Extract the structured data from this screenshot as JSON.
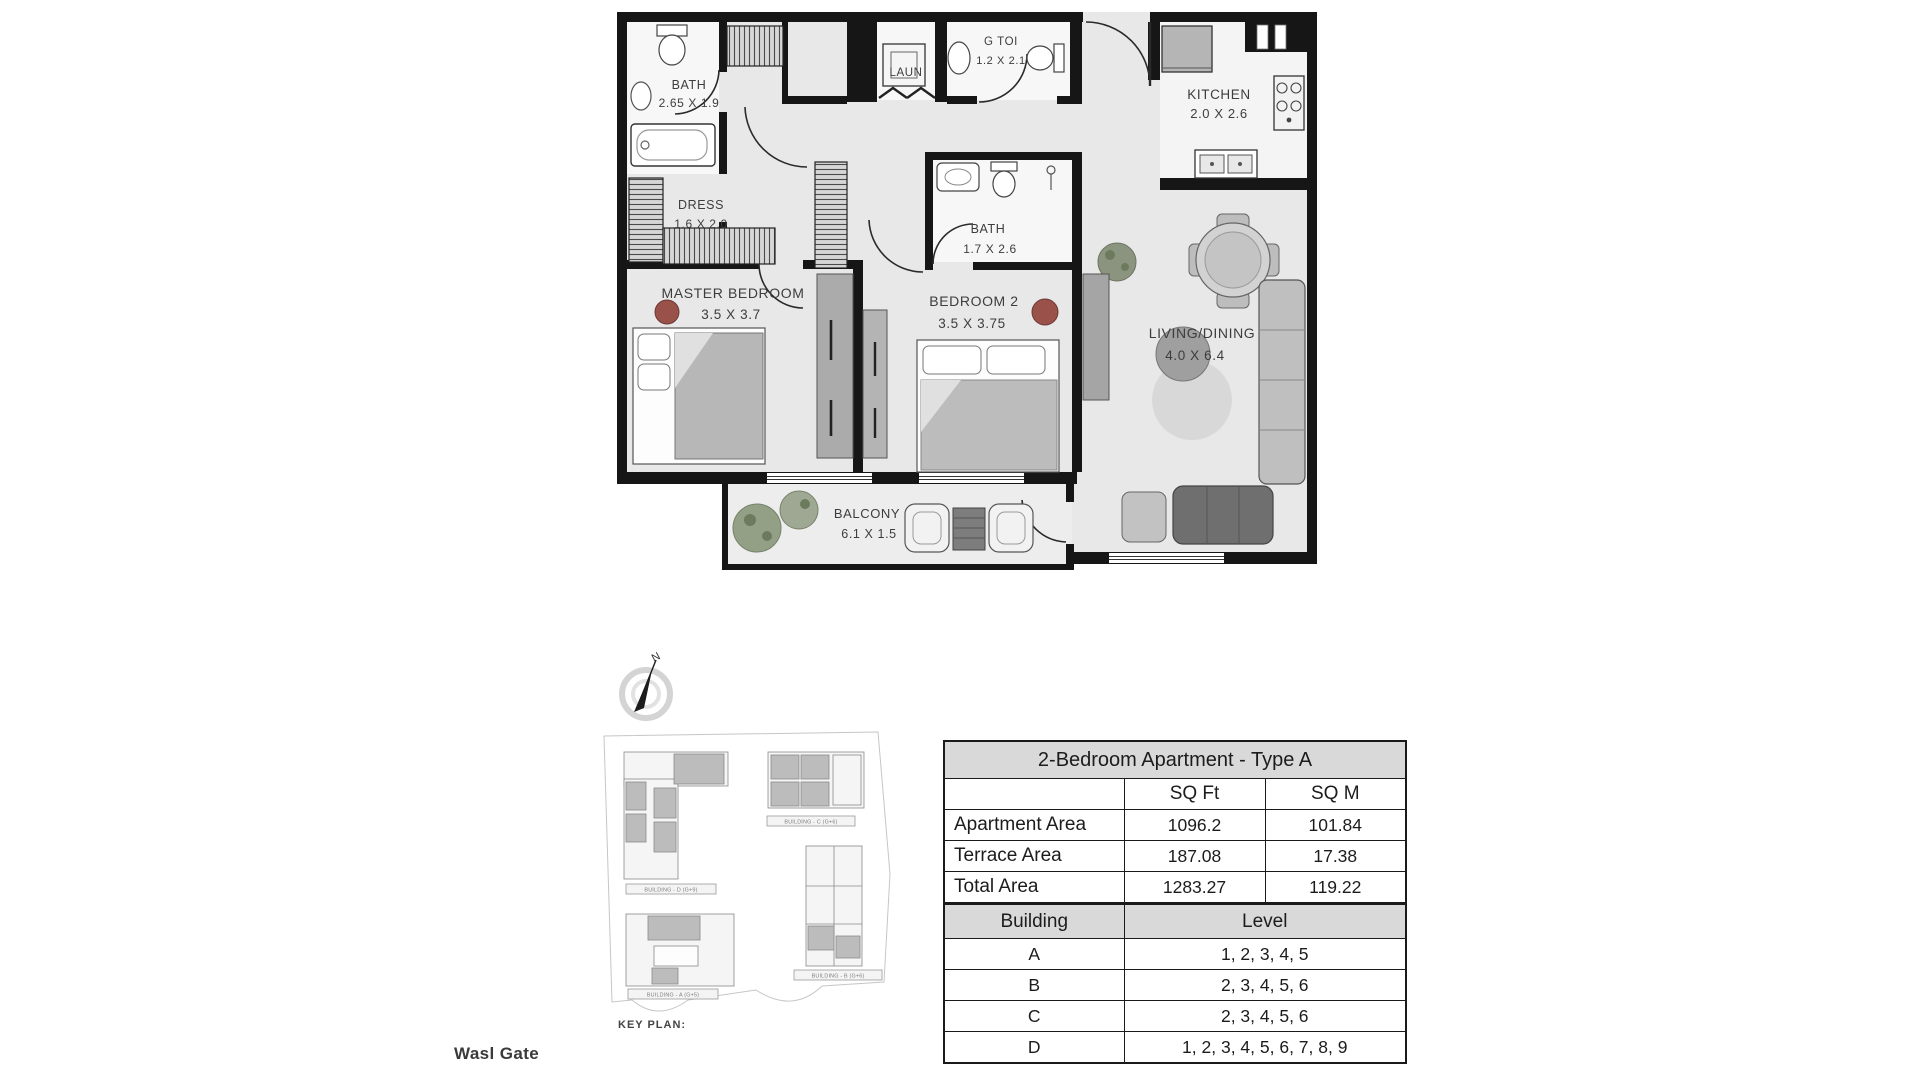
{
  "page": {
    "project_label": "Wasl Gate"
  },
  "floor_plan": {
    "compass_label": "N",
    "rooms": {
      "bath1": {
        "name": "BATH",
        "dims": "2.65 X 1.9"
      },
      "dress": {
        "name": "DRESS",
        "dims": "1.6 X 2.0"
      },
      "laundry": {
        "name": "LAUN",
        "dims": ""
      },
      "guest_toilet": {
        "name": "G TOI",
        "dims": "1.2 X 2.1"
      },
      "kitchen": {
        "name": "KITCHEN",
        "dims": "2.0 X 2.6"
      },
      "bath2": {
        "name": "BATH",
        "dims": "1.7 X 2.6"
      },
      "master_bedroom": {
        "name": "MASTER BEDROOM",
        "dims": "3.5 X 3.7"
      },
      "bedroom2": {
        "name": "BEDROOM 2",
        "dims": "3.5 X 3.75"
      },
      "living_dining": {
        "name": "LIVING/DINING",
        "dims": "4.0 X 6.4"
      },
      "balcony": {
        "name": "BALCONY",
        "dims": "6.1 X 1.5"
      }
    }
  },
  "key_plan": {
    "title": "KEY PLAN:",
    "buildings": {
      "d": {
        "label": "BUILDING - D (G+9)"
      },
      "c": {
        "label": "BUILDING - C (G+6)"
      },
      "a": {
        "label": "BUILDING - A (G+5)"
      },
      "b": {
        "label": "BUILDING - B (G+6)"
      }
    }
  },
  "area_table": {
    "title": "2-Bedroom Apartment - Type A",
    "col_sqft": "SQ Ft",
    "col_sqm": "SQ M",
    "rows": [
      {
        "label": "Apartment Area",
        "sqft": "1096.2",
        "sqm": "101.84"
      },
      {
        "label": "Terrace Area",
        "sqft": "187.08",
        "sqm": "17.38"
      },
      {
        "label": "Total Area",
        "sqft": "1283.27",
        "sqm": "119.22"
      }
    ]
  },
  "level_table": {
    "col_building": "Building",
    "col_level": "Level",
    "rows": [
      {
        "building": "A",
        "levels": "1, 2, 3, 4, 5"
      },
      {
        "building": "B",
        "levels": "2, 3, 4, 5, 6"
      },
      {
        "building": "C",
        "levels": "2, 3, 4, 5, 6"
      },
      {
        "building": "D",
        "levels": "1, 2, 3, 4, 5, 6, 7, 8, 9"
      }
    ]
  }
}
